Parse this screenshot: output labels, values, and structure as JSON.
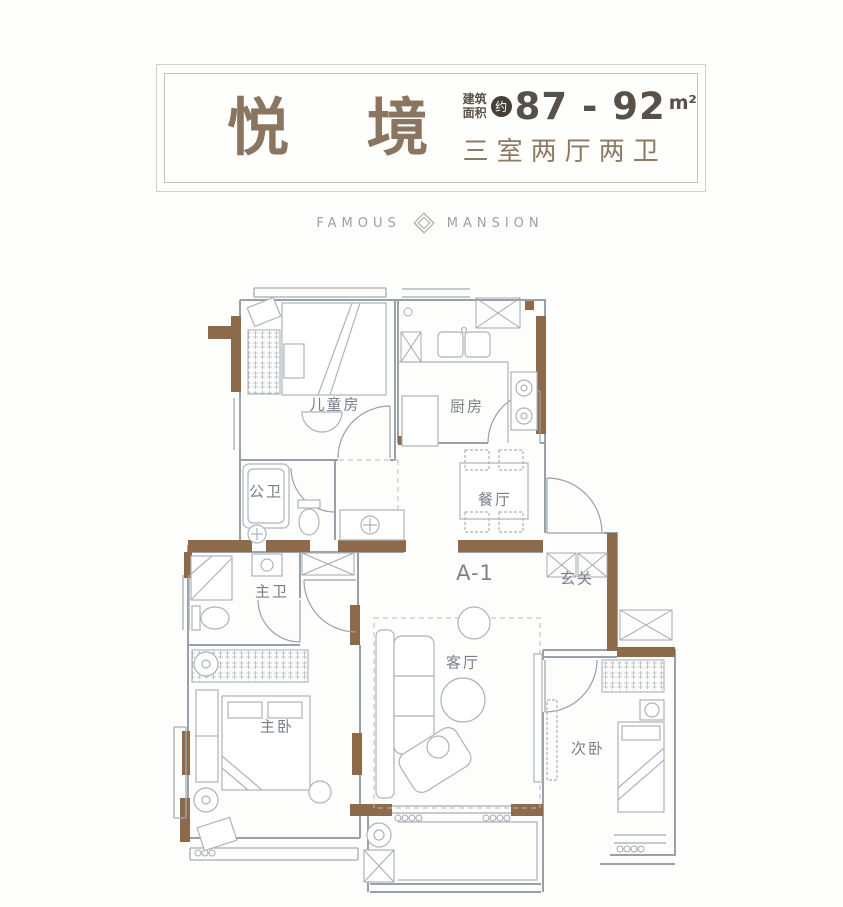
{
  "header": {
    "title": "悦 境",
    "area_label_line1": "建筑",
    "area_label_line2": "面积",
    "approx_badge": "约",
    "area_value": "87 - 92",
    "area_unit": "m²",
    "layout_summary": "三室两厅两卫"
  },
  "brand": {
    "word_left": "FAMOUS",
    "word_right": "MANSION",
    "logo": "diamond-logo"
  },
  "plan": {
    "unit_code": "A-1",
    "rooms": {
      "children_room": "儿童房",
      "kitchen": "厨房",
      "public_bath": "公卫",
      "dining_room": "餐厅",
      "master_bath": "主卫",
      "entrance": "玄关",
      "living_room": "客厅",
      "master_bedroom": "主卧",
      "second_bedroom": "次卧"
    }
  },
  "colors": {
    "wall_accent_brown": "#8d6a4a",
    "wall_line_gray": "#98a0a8",
    "furniture_line_gray": "#adb3bb",
    "title_brown": "#8a7560",
    "area_text": "#57514a",
    "subtitle_brown": "#8c7a62",
    "brand_gray": "#9aa0a6",
    "room_label_gray": "#787f88",
    "badge_bg": "#453f38"
  }
}
